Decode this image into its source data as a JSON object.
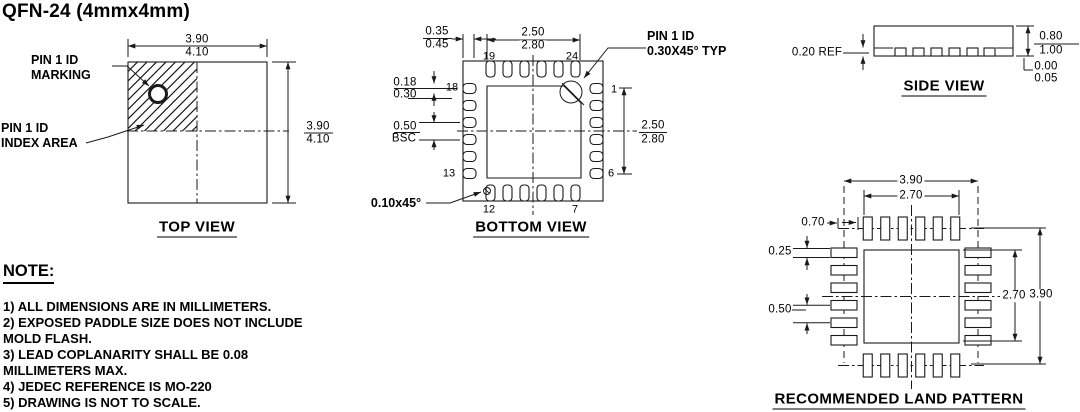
{
  "title": "QFN-24 (4mmx4mm)",
  "top_view": {
    "caption": "TOP VIEW",
    "marking_label_1": "PIN 1 ID",
    "marking_label_2": "MARKING",
    "index_label_1": "PIN 1 ID",
    "index_label_2": "INDEX AREA",
    "dim_width_over": "3.90",
    "dim_width_under": "4.10",
    "dim_height_over": "3.90",
    "dim_height_under": "4.10"
  },
  "bottom_view": {
    "caption": "BOTTOM VIEW",
    "pin1_label_1": "PIN 1 ID",
    "pin1_label_2": "0.30X45° TYP",
    "chamfer_label": "0.10x45°",
    "dim_lead_len_over": "0.35",
    "dim_lead_len_under": "0.45",
    "dim_paddle_w_over": "2.50",
    "dim_paddle_w_under": "2.80",
    "dim_lead_w_over": "0.18",
    "dim_lead_w_under": "0.30",
    "dim_pitch_over": "0.50",
    "dim_pitch_under": "BSC",
    "dim_paddle_h_over": "2.50",
    "dim_paddle_h_under": "2.80",
    "pins": {
      "p19": "19",
      "p24": "24",
      "p18": "18",
      "p13": "13",
      "p12": "12",
      "p7": "7",
      "p1": "1",
      "p6": "6"
    }
  },
  "side_view": {
    "caption": "SIDE VIEW",
    "dim_lead_thickness": "0.20 REF",
    "dim_height_over": "0.80",
    "dim_height_under": "1.00",
    "dim_standoff_over": "0.00",
    "dim_standoff_under": "0.05"
  },
  "land_pattern": {
    "caption": "RECOMMENDED LAND PATTERN",
    "dim_outer_width": "3.90",
    "dim_inner_width": "2.70",
    "dim_pad_length": "0.70",
    "dim_pad_width": "0.25",
    "dim_pitch": "0.50",
    "dim_inner_height": "2.70",
    "dim_outer_height": "3.90"
  },
  "notes": {
    "heading": "NOTE:",
    "lines": [
      "1) ALL DIMENSIONS ARE IN MILLIMETERS.",
      "2) EXPOSED PADDLE SIZE DOES NOT INCLUDE",
      "MOLD FLASH.",
      "3) LEAD COPLANARITY SHALL BE 0.08",
      "MILLIMETERS MAX.",
      "4) JEDEC REFERENCE IS MO-220",
      "5) DRAWING IS NOT TO SCALE."
    ]
  }
}
